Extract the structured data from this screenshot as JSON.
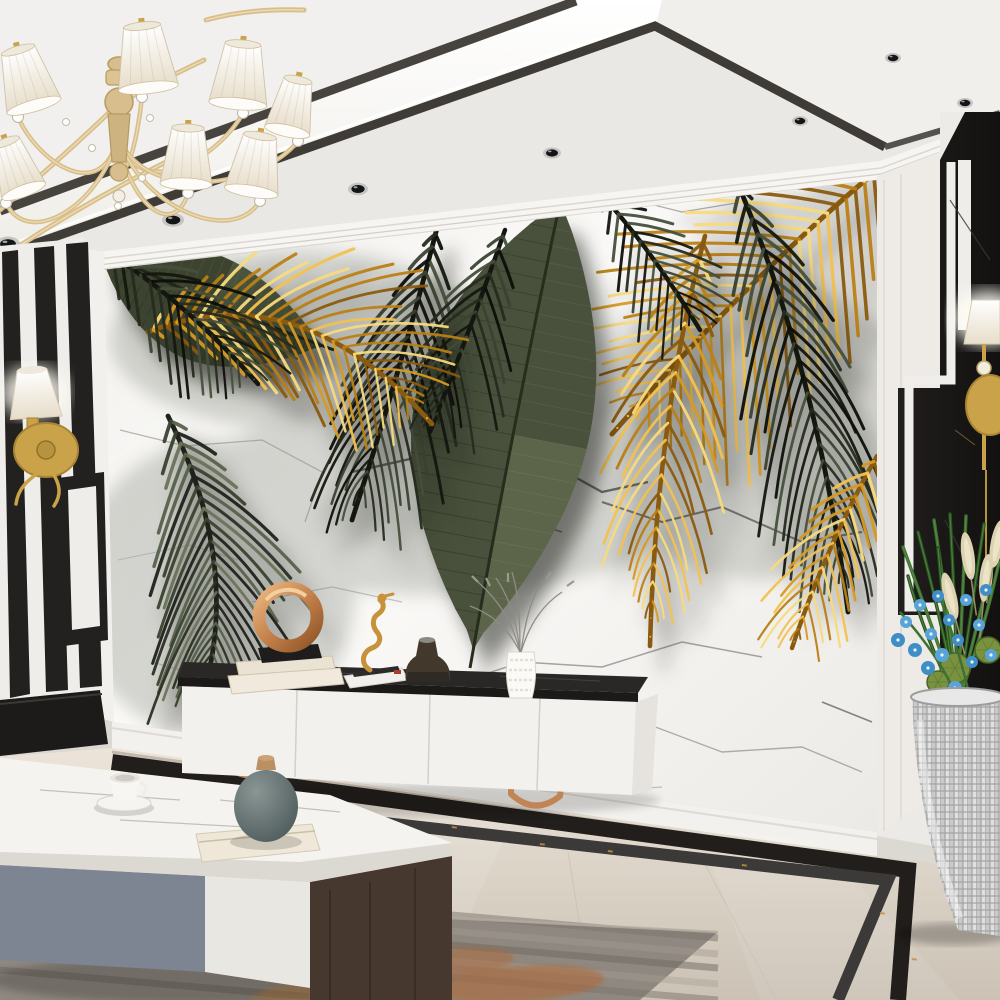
{
  "colors": {
    "ceiling_white": "#f1f0ee",
    "cove_glow": "#fbfaf5",
    "trim_dark": "#45413c",
    "lower_ceiling": "#eae8e4",
    "crown_white": "#f7f5f2",
    "marble_bg": "#f7f6f3",
    "vein_grey": "#8f8f8d",
    "vein_dark": "#4a4a48",
    "gold_leaf": "#d79a22",
    "gold_leaf_hi": "#f2c14e",
    "leaf_dark": "#262b1f",
    "leaf_sage": "#55604a",
    "banana_green": "#49513c",
    "stripe_black": "#23211f",
    "black_marble": "#191715",
    "gold_metal": "#c9a24a",
    "chandelier_gold": "#d8be8c",
    "shade_white": "#f7f3ea",
    "console_white": "#f3f1ee",
    "console_top_black": "#232120",
    "leg_rosegold": "#c08455",
    "floor_beige": "#d9d0c4",
    "floor_border_black": "#221e1b",
    "floor_fleck_gold": "#c49043",
    "rug_grey": "#8f8880",
    "rug_orange": "#b4622a",
    "table_marble": "#f5f3f0",
    "drawer_grey": "#7c8591",
    "drawer_white": "#e9e7e2",
    "table_wood": "#46382e",
    "leg_black": "#1c1c1c",
    "vase_teal": "#5d6a6a",
    "wood_cap": "#b98f63",
    "cream_book": "#e9e2d3",
    "ring_copper": "#c5814b",
    "bronze_vase": "#42382c",
    "plant_green": "#3f7031",
    "orchid_blue": "#58a3d8",
    "plume_cream": "#ddd3b2",
    "pod_green": "#78923f",
    "planter_silver": "#cfcfcf"
  },
  "scene": {
    "ceiling": {
      "spotlights": [
        [
          8,
          244,
          12
        ],
        [
          173,
          220,
          11
        ],
        [
          358,
          189,
          10
        ],
        [
          552,
          153,
          9
        ],
        [
          800,
          121,
          8
        ],
        [
          893,
          58,
          8
        ],
        [
          965,
          103,
          8
        ]
      ]
    },
    "chandelier": {
      "center": [
        118,
        136
      ],
      "shades": [
        {
          "x": 18,
          "y": 50,
          "w": 56,
          "h": 58,
          "rot": -16
        },
        {
          "x": 142,
          "y": 26,
          "w": 60,
          "h": 62,
          "rot": -6
        },
        {
          "x": 243,
          "y": 44,
          "w": 58,
          "h": 60,
          "rot": 5
        },
        {
          "x": 298,
          "y": 80,
          "w": 46,
          "h": 52,
          "rot": 12
        },
        {
          "x": 188,
          "y": 128,
          "w": 52,
          "h": 56,
          "rot": 2
        },
        {
          "x": 260,
          "y": 136,
          "w": 54,
          "h": 56,
          "rot": 9
        },
        {
          "x": 6,
          "y": 142,
          "w": 46,
          "h": 52,
          "rot": -20
        }
      ],
      "sweeps": [
        [
          0,
          210,
          60,
          160,
          118,
          104
        ],
        [
          16,
          248,
          90,
          200,
          170,
          160
        ],
        [
          206,
          20,
          250,
          8,
          304,
          10
        ],
        [
          118,
          104,
          150,
          86,
          204,
          60
        ]
      ],
      "sparkles": [
        [
          150,
          118
        ],
        [
          92,
          148
        ],
        [
          142,
          178
        ],
        [
          66,
          122
        ],
        [
          118,
          206
        ]
      ]
    },
    "palettes": {
      "gold": [
        "#8a5a0e",
        "#d79a22",
        "#f2c14e",
        "#f7da7c",
        "#b97f14"
      ],
      "dark": [
        "#14170f",
        "#262b1f",
        "#3a4231",
        "#0d0f0a",
        "#454f3c"
      ],
      "sage": [
        "#1d221a",
        "#39412f",
        "#55604a",
        "#2a3023",
        "#6a7258"
      ]
    },
    "leaves": [
      {
        "id": "leaf-frond-gold-hero",
        "type": "frond",
        "pal": "gold",
        "rib": [
          905,
          148,
          772,
          252,
          612,
          434
        ],
        "n": 30,
        "len": 165,
        "spread": 58,
        "droop": 0.12,
        "w": 3.4,
        "seed": 1,
        "shadow": true
      },
      {
        "id": "leaf-frond-dark-right",
        "type": "frond",
        "pal": "dark",
        "rib": [
          737,
          182,
          818,
          372,
          848,
          612
        ],
        "n": 26,
        "len": 150,
        "spread": 40,
        "droop": 0.55,
        "w": 3.2,
        "seed": 2,
        "shadow": true
      },
      {
        "id": "leaf-frond-gold-droop",
        "type": "frond",
        "pal": "gold",
        "rib": [
          705,
          236,
          656,
          422,
          650,
          646
        ],
        "n": 24,
        "len": 112,
        "spread": 46,
        "droop": 0.5,
        "w": 3.0,
        "seed": 3,
        "shadow": true
      },
      {
        "id": "leaf-frond-gold-tail",
        "type": "frond",
        "pal": "gold",
        "rib": [
          877,
          456,
          826,
          546,
          792,
          648
        ],
        "n": 16,
        "len": 85,
        "spread": 48,
        "droop": 0.35,
        "w": 2.8,
        "seed": 4,
        "shadow": false
      },
      {
        "id": "leaf-banana-center",
        "type": "banana",
        "rib": [
          558,
          212,
          512,
          430,
          470,
          668
        ],
        "maxw": 92,
        "base": "#49513c",
        "light": "#6f7a57",
        "ribc": "#272d1d",
        "shadow": true
      },
      {
        "id": "leaf-banana-left",
        "type": "banana",
        "rib": [
          105,
          252,
          212,
          306,
          334,
          350
        ],
        "maxw": 56,
        "base": "#3c4430",
        "light": "#5a634a",
        "ribc": "#20261a",
        "shadow": true
      },
      {
        "id": "leaf-frond-dark-center",
        "type": "frond",
        "pal": "dark",
        "rib": [
          437,
          228,
          402,
          366,
          352,
          520
        ],
        "n": 22,
        "len": 130,
        "spread": 42,
        "droop": 0.5,
        "w": 3.2,
        "seed": 5,
        "shadow": true
      },
      {
        "id": "leaf-frond-dark-center-2",
        "type": "frond",
        "pal": "dark",
        "rib": [
          505,
          230,
          470,
          330,
          430,
          432
        ],
        "n": 16,
        "len": 90,
        "spread": 45,
        "droop": 0.4,
        "w": 2.8,
        "seed": 6,
        "shadow": false
      },
      {
        "id": "leaf-frond-dark-top",
        "type": "frond",
        "pal": "dark",
        "rib": [
          600,
          193,
          652,
          250,
          700,
          330
        ],
        "n": 14,
        "len": 82,
        "spread": 50,
        "droop": 0.2,
        "w": 2.8,
        "seed": 7,
        "shadow": false
      },
      {
        "id": "leaf-frond-gold-left",
        "type": "frond",
        "pal": "gold",
        "rib": [
          148,
          332,
          300,
          272,
          432,
          424
        ],
        "n": 26,
        "len": 125,
        "spread": 55,
        "droop": 0.2,
        "w": 3.2,
        "seed": 8,
        "shadow": true
      },
      {
        "id": "leaf-frond-dark-topleft",
        "type": "frond",
        "pal": "dark",
        "rib": [
          98,
          246,
          185,
          300,
          258,
          384
        ],
        "n": 18,
        "len": 95,
        "spread": 48,
        "droop": 0.3,
        "w": 3.0,
        "seed": 9,
        "shadow": false
      },
      {
        "id": "leaf-frond-left-hang",
        "type": "frond",
        "pal": "sage",
        "rib": [
          168,
          416,
          240,
          560,
          205,
          688
        ],
        "n": 26,
        "len": 140,
        "spread": 46,
        "droop": 0.35,
        "w": 3.2,
        "seed": 10,
        "shadow": true
      }
    ],
    "mural": {
      "veins": [
        {
          "p": [
            [
              120,
              430
            ],
            [
              185,
              446
            ],
            [
              262,
              440
            ],
            [
              322,
              472
            ],
            [
              305,
              522
            ]
          ],
          "c": "#9a9a98",
          "w": 1.2,
          "o": 0.7
        },
        {
          "p": [
            [
              352,
              472
            ],
            [
              432,
              454
            ],
            [
              472,
              476
            ],
            [
              544,
              460
            ],
            [
              602,
              492
            ],
            [
              648,
              482
            ]
          ],
          "c": "#4a4a48",
          "w": 2.4,
          "o": 0.9
        },
        {
          "p": [
            [
              472,
              476
            ],
            [
              502,
              512
            ],
            [
              562,
              532
            ]
          ],
          "c": "#5a5a58",
          "w": 1.6,
          "o": 0.8
        },
        {
          "p": [
            [
              430,
              692
            ],
            [
              522,
              662
            ],
            [
              602,
              667
            ],
            [
              682,
              642
            ],
            [
              762,
              657
            ]
          ],
          "c": "#8f8f8d",
          "w": 1.5,
          "o": 0.8
        },
        {
          "p": [
            [
              602,
              502
            ],
            [
              662,
              522
            ],
            [
              722,
              507
            ],
            [
              802,
              542
            ],
            [
              862,
              532
            ]
          ],
          "c": "#55524e",
          "w": 2.0,
          "o": 0.85
        },
        {
          "p": [
            [
              252,
              602
            ],
            [
              332,
              587
            ],
            [
              402,
              602
            ]
          ],
          "c": "#a0a09e",
          "w": 1.2,
          "o": 0.6
        },
        {
          "p": [
            [
              642,
              722
            ],
            [
              722,
              752
            ],
            [
              802,
              747
            ],
            [
              862,
              772
            ]
          ],
          "c": "#8f8f8d",
          "w": 1.4,
          "o": 0.7
        },
        {
          "p": [
            [
              152,
              662
            ],
            [
              222,
              682
            ],
            [
              302,
              692
            ]
          ],
          "c": "#9a9a98",
          "w": 1.1,
          "o": 0.6
        },
        {
          "p": [
            [
              622,
              197
            ],
            [
              682,
              212
            ],
            [
              742,
              202
            ]
          ],
          "c": "#8f8f8d",
          "w": 1.3,
          "o": 0.7
        },
        {
          "p": [
            [
              502,
              772
            ],
            [
              582,
              792
            ],
            [
              662,
              787
            ]
          ],
          "c": "#9a9a98",
          "w": 1.2,
          "o": 0.6
        },
        {
          "p": [
            [
              822,
              702
            ],
            [
              872,
              722
            ]
          ],
          "c": "#6a6765",
          "w": 1.6,
          "o": 0.8
        },
        {
          "p": [
            [
              118,
              560
            ],
            [
              190,
              545
            ],
            [
              238,
              560
            ]
          ],
          "c": "#a8a8a6",
          "w": 1.0,
          "o": 0.55
        }
      ]
    },
    "plant": {
      "blades": [
        [
          958,
          702,
          930,
          620,
          903,
          547
        ],
        [
          958,
          702,
          940,
          615,
          918,
          532
        ],
        [
          958,
          702,
          948,
          610,
          934,
          520
        ],
        [
          958,
          702,
          955,
          605,
          950,
          514
        ],
        [
          958,
          702,
          962,
          605,
          966,
          516
        ],
        [
          958,
          702,
          972,
          608,
          984,
          524
        ],
        [
          958,
          702,
          980,
          615,
          997,
          540
        ],
        [
          958,
          702,
          925,
          640,
          908,
          576
        ],
        [
          958,
          702,
          985,
          628,
          999,
          562
        ],
        [
          958,
          702,
          945,
          630,
          938,
          548
        ]
      ],
      "plumes": [
        [
          968,
          556,
          -8
        ],
        [
          986,
          578,
          6
        ],
        [
          950,
          596,
          -14
        ],
        [
          997,
          544,
          10
        ]
      ],
      "orchids": [
        [
          898,
          640,
          7
        ],
        [
          906,
          622,
          6
        ],
        [
          915,
          650,
          7
        ],
        [
          920,
          605,
          6
        ],
        [
          928,
          668,
          7
        ],
        [
          931,
          634,
          6
        ],
        [
          938,
          596,
          6
        ],
        [
          942,
          655,
          7
        ],
        [
          949,
          620,
          6
        ],
        [
          955,
          688,
          7
        ],
        [
          958,
          640,
          6
        ],
        [
          966,
          600,
          6
        ],
        [
          972,
          662,
          6
        ],
        [
          979,
          625,
          6
        ],
        [
          986,
          590,
          6
        ],
        [
          991,
          655,
          6
        ]
      ],
      "pods": [
        [
          955,
          668,
          15
        ],
        [
          988,
          650,
          13
        ],
        [
          938,
          682,
          11
        ]
      ]
    },
    "rug": {
      "stripes": [
        [
          876,
          "#7b746c",
          0.5
        ],
        [
          892,
          "#a39a90",
          0.45
        ],
        [
          906,
          "#6e6760",
          0.5
        ],
        [
          922,
          "#a89f94",
          0.4
        ],
        [
          938,
          "#7b746c",
          0.5
        ],
        [
          954,
          "#948b81",
          0.45
        ],
        [
          970,
          "#6e6760",
          0.5
        ]
      ],
      "blobs": [
        [
          300,
          952,
          70,
          16,
          "#b4622a",
          0.5
        ],
        [
          452,
          962,
          62,
          14,
          "#b4622a",
          0.45
        ],
        [
          186,
          934,
          52,
          12,
          "#cf8a44",
          0.4
        ],
        [
          520,
          984,
          84,
          18,
          "#b4622a",
          0.5
        ],
        [
          78,
          908,
          56,
          13,
          "#6f675f",
          0.5
        ],
        [
          350,
          995,
          100,
          20,
          "#c8813b",
          0.45
        ]
      ]
    },
    "floor": {
      "flecks": [
        [
          310,
          800
        ],
        [
          452,
          826
        ],
        [
          608,
          850
        ],
        [
          742,
          864
        ],
        [
          880,
          912
        ],
        [
          912,
          958
        ],
        [
          540,
          843
        ],
        [
          200,
          782
        ]
      ]
    }
  }
}
